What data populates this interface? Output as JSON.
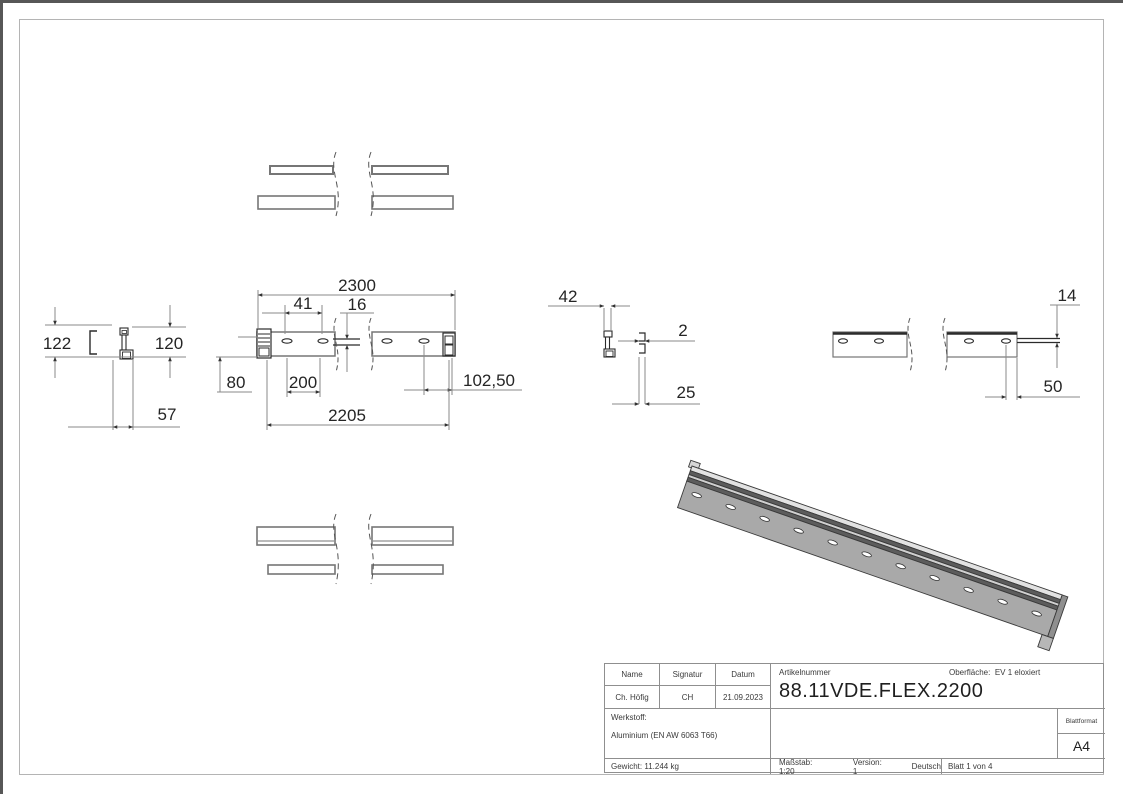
{
  "colors": {
    "dim_line": "#8a8a8a",
    "outline": "#6f6f6f",
    "dark_line": "#2b2b2b",
    "iso_body": "#a9a9a9",
    "iso_groove": "#5c5c5c"
  },
  "drawing": {
    "dims": {
      "total_length": "2300",
      "first_hole_offset": "41",
      "slot_width": "16",
      "bottom_edge_offset": "80",
      "hole_pitch": "200",
      "end_hole_distance": "102,50",
      "hole_span": "2205",
      "profile_depth": "57",
      "overall_height": "122",
      "body_height": "120",
      "top_width": "42",
      "wall_thickness": "2",
      "bottom_width": "25",
      "tab_thickness": "14",
      "last_hole_offset": "50"
    }
  },
  "title_block": {
    "headers": {
      "name": "Name",
      "signatur": "Signatur",
      "datum": "Datum"
    },
    "values": {
      "name": "Ch. Höfig",
      "signatur": "CH",
      "datum": "21.09.2023"
    },
    "artikelnummer_label": "Artikelnummer",
    "artikelnummer": "88.11VDE.FLEX.2200",
    "oberflaeche_label": "Oberfläche:",
    "oberflaeche_value": "EV 1 eloxiert",
    "werkstoff_label": "Werkstoff:",
    "werkstoff_value": "Aluminium (EN AW 6063 T66)",
    "blattformat_label": "Blattformat",
    "blattformat_value": "A4",
    "gewicht": "Gewicht: 11.244 kg",
    "massstab": "Maßstab: 1:20",
    "version": "Version: 1",
    "sprache": "Deutsch",
    "blatt": "Blatt 1 von 4"
  }
}
